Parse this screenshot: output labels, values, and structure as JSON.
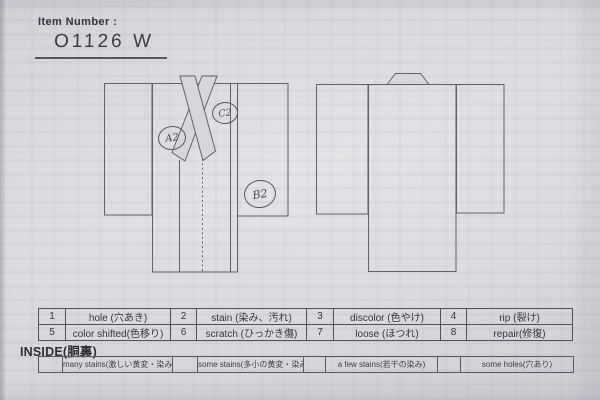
{
  "header": {
    "item_number_label": "Item Number :",
    "item_number_value": "O1126  W"
  },
  "diagram": {
    "front_view": "kimono-front-with-crossed-collar",
    "back_view": "kimono-back-with-neckband",
    "annotations": [
      {
        "label": "A2",
        "position": "front-left-chest"
      },
      {
        "label": "C2",
        "position": "front-right-shoulder"
      },
      {
        "label": "B2",
        "position": "front-right-sleeve-lower"
      }
    ]
  },
  "defect_table": {
    "rows": [
      [
        {
          "code": "1",
          "label": "hole (穴あき)"
        },
        {
          "code": "2",
          "label": "stain (染み、汚れ)"
        },
        {
          "code": "3",
          "label": "discolor (色やけ)"
        },
        {
          "code": "4",
          "label": "rip (裂け)"
        }
      ],
      [
        {
          "code": "5",
          "label": "color shifted(色移り)"
        },
        {
          "code": "6",
          "label": "scratch (ひっかき傷)"
        },
        {
          "code": "7",
          "label": "loose (ほつれ)"
        },
        {
          "code": "8",
          "label": "repair(修復)"
        }
      ]
    ]
  },
  "inside_section": {
    "title": "INSIDE(胴裏)",
    "options": [
      "many stains(激しい黄変・染み)",
      "some stains(多小の黄変・染み)",
      "a few stains(若干の染み)",
      "some holes(穴あり)"
    ]
  },
  "colors": {
    "paper": "#d5d6da",
    "ink": "#33353c",
    "line": "#60626b",
    "handwriting": "#45474f"
  }
}
